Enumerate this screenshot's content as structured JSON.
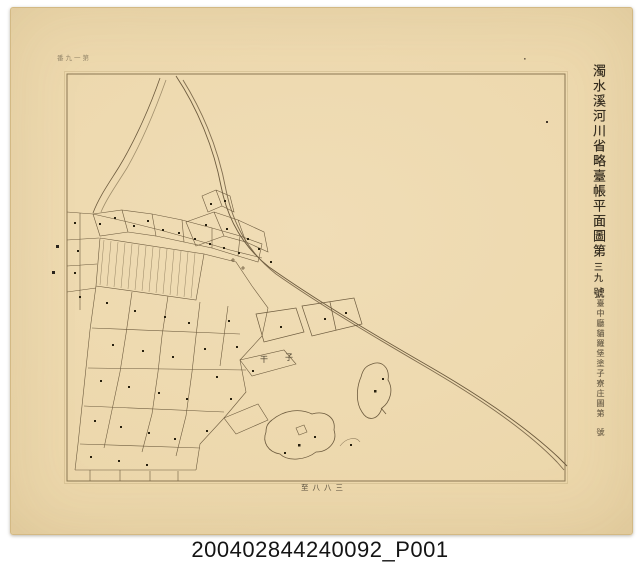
{
  "colors": {
    "paper": "#ecd7ab",
    "ink": "#6d5b3e",
    "frame": "#8a7652",
    "caption_text": "#141414"
  },
  "right_margin": {
    "title_main": "濁水溪河川省略臺帳平面圖第",
    "title_number": "三九",
    "title_unit": "號",
    "subtitle_main": "臺中廳貓羅堡塗子寮庄圖第",
    "subtitle_unit": "號"
  },
  "margins": {
    "top_left_note": "番九一第",
    "bottom_note": "至八八三"
  },
  "map": {
    "labels": [
      {
        "text": "干"
      },
      {
        "text": "子"
      }
    ]
  },
  "caption": "200402844240092_P001"
}
